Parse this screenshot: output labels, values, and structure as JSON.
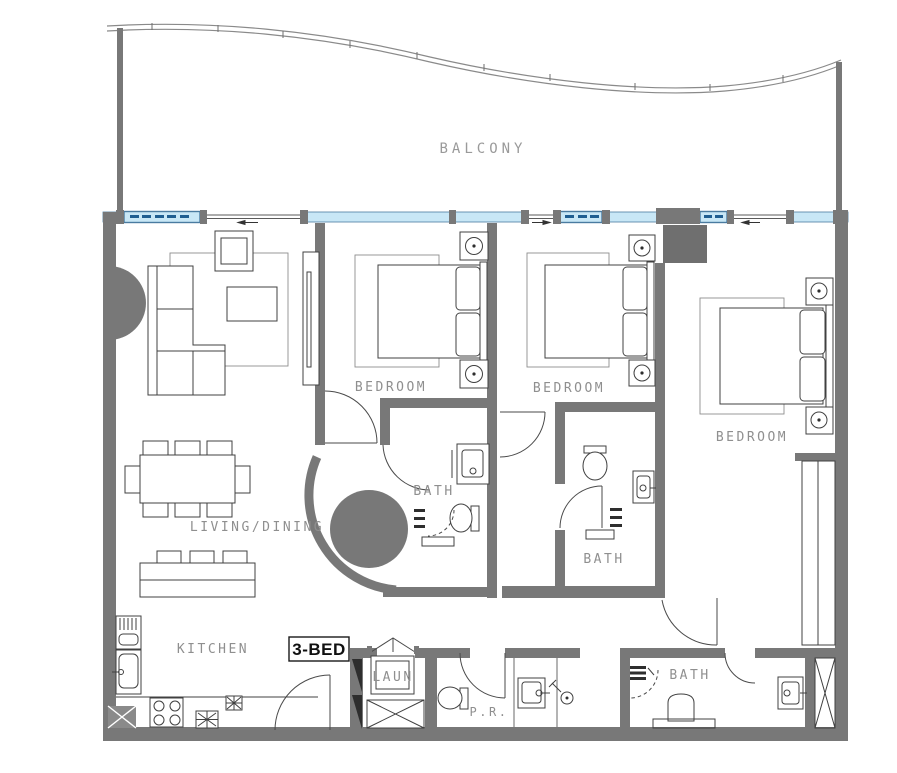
{
  "meta": {
    "type": "architectural-floor-plan",
    "unit_type": "3-bedroom apartment"
  },
  "labels": {
    "balcony": "BALCONY",
    "bedroom_1": "BEDROOM",
    "bedroom_2": "BEDROOM",
    "bedroom_3": "BEDROOM",
    "bath_1": "BATH",
    "bath_2": "BATH",
    "bath_3": "BATH",
    "living_dining": "LIVING/DINING",
    "kitchen": "KITCHEN",
    "laundry": "LAUN",
    "powder_room": "P.R.",
    "unit_badge": "3-BED"
  },
  "colors": {
    "background": "#ffffff",
    "wall": "#787878",
    "wall_dark": "#6f6f6f",
    "rail": "#8a8a8a",
    "window_fill": "#c8e7f6",
    "window_frame": "#4a7ba0",
    "window_dash": "#1f5e91",
    "line": "#404040",
    "label": "#8f8f8f",
    "badge_text": "#101010"
  },
  "icons": {
    "bed_count": 3,
    "bath_count": 3,
    "nightstand_lamp": "circle-with-dot",
    "shaft": "crossed-box",
    "sliding_window": "dashed-pane"
  }
}
